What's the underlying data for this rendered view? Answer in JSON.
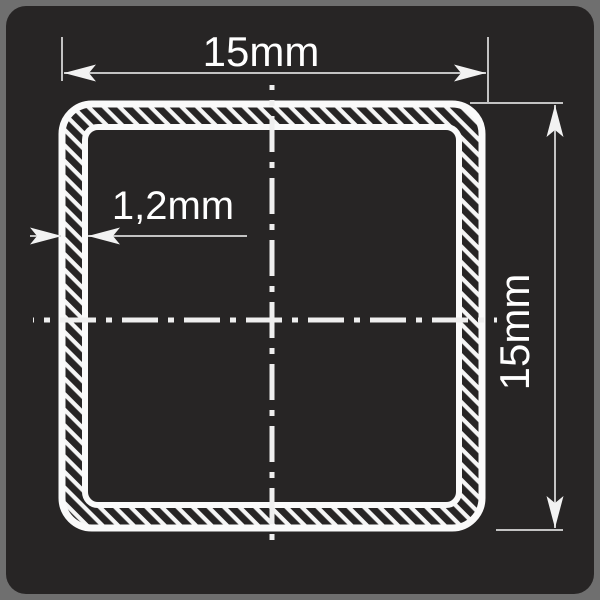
{
  "drawing": {
    "type": "technical-cross-section",
    "subject": "square hollow tube profile",
    "dimensions": {
      "width_label": "15mm",
      "height_label": "15mm",
      "wall_thickness_label": "1,2mm"
    },
    "colors": {
      "frame_bg": "#6f6f6f",
      "panel_bg": "#272525",
      "tube_line": "#fafafa",
      "hatch_line": "#f5f5f5",
      "dimension_line": "#c3c3c3",
      "text": "#ffffff"
    }
  }
}
